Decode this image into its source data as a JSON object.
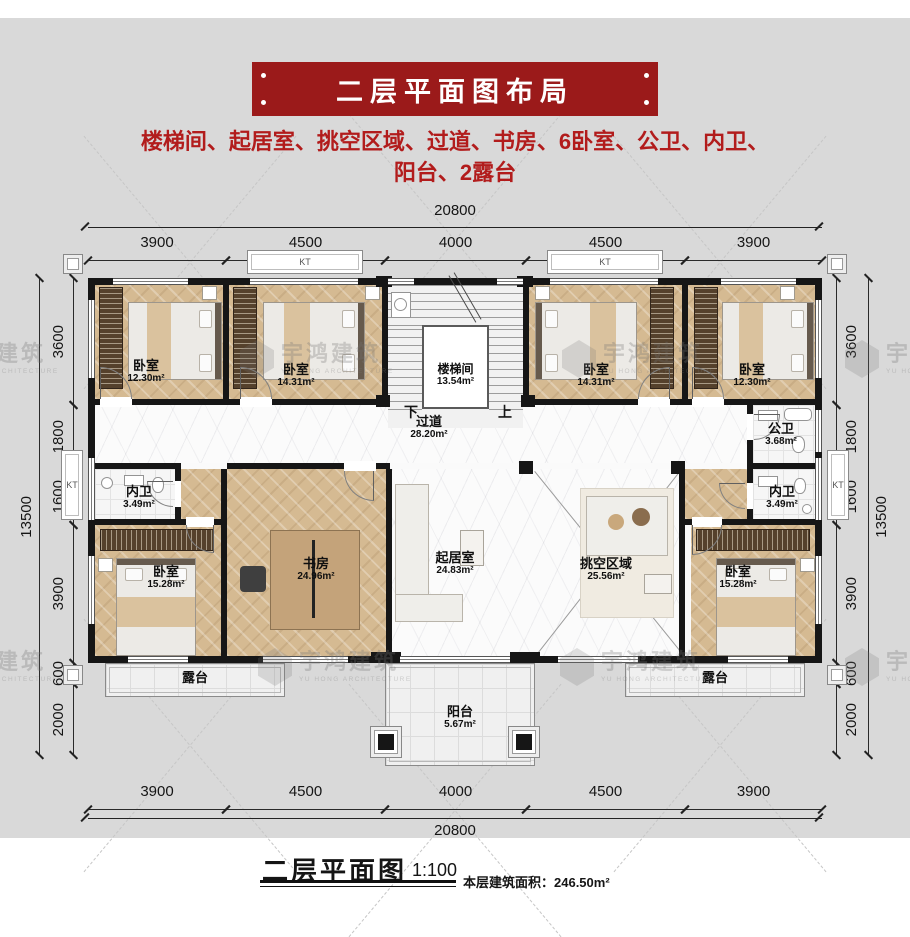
{
  "header": {
    "banner_title": "二层平面图布局",
    "subtitle_line1": "楼梯间、起居室、挑空区域、过道、书房、6卧室、公卫、内卫、",
    "subtitle_line2": "阳台、2露台"
  },
  "colors": {
    "banner_bg": "#9b1a1a",
    "subtitle_text": "#b21c1c",
    "wall": "#161616",
    "wood_floor": "#d5ba92",
    "page_gray": "#d9d9d9"
  },
  "rooms": {
    "bed_tl": {
      "name": "卧室",
      "area": "12.30m²"
    },
    "bed_tl2": {
      "name": "卧室",
      "area": "14.31m²"
    },
    "stair": {
      "name": "楼梯间",
      "area": "13.54m²"
    },
    "bed_tr2": {
      "name": "卧室",
      "area": "14.31m²"
    },
    "bed_tr": {
      "name": "卧室",
      "area": "12.30m²"
    },
    "corridor": {
      "name": "过道",
      "area": "28.20m²"
    },
    "bath_public": {
      "name": "公卫",
      "area": "3.68m²"
    },
    "bath_left": {
      "name": "内卫",
      "area": "3.49m²"
    },
    "bath_right": {
      "name": "内卫",
      "area": "3.49m²"
    },
    "bed_bl": {
      "name": "卧室",
      "area": "15.28m²"
    },
    "study": {
      "name": "书房",
      "area": "24.96m²"
    },
    "living": {
      "name": "起居室",
      "area": "24.83m²"
    },
    "void": {
      "name": "挑空区域",
      "area": "25.56m²"
    },
    "bed_br": {
      "name": "卧室",
      "area": "15.28m²"
    },
    "terrace_left": {
      "name": "露台"
    },
    "terrace_right": {
      "name": "露台"
    },
    "balcony": {
      "name": "阳台",
      "area": "5.67m²"
    }
  },
  "stair_labels": {
    "down": "下",
    "up": "上"
  },
  "kt": "KT",
  "dims": {
    "top_total": "20800",
    "bottom_total": "20800",
    "side_total": "13500",
    "top_segments": [
      "3900",
      "4500",
      "4000",
      "4500",
      "3900"
    ],
    "bottom_segments": [
      "3900",
      "4500",
      "4000",
      "4500",
      "3900"
    ],
    "left_segments": [
      "3600",
      "1800",
      "1600",
      "3900",
      "600",
      "2000"
    ],
    "right_segments": [
      "3600",
      "1800",
      "1600",
      "3900",
      "600",
      "2000"
    ]
  },
  "watermark": {
    "cn": "宇鸿建筑",
    "en": "YU HONG ARCHITECTURE"
  },
  "caption": {
    "title": "二层平面图",
    "scale": "1:100",
    "area": "本层建筑面积：246.50m²"
  }
}
